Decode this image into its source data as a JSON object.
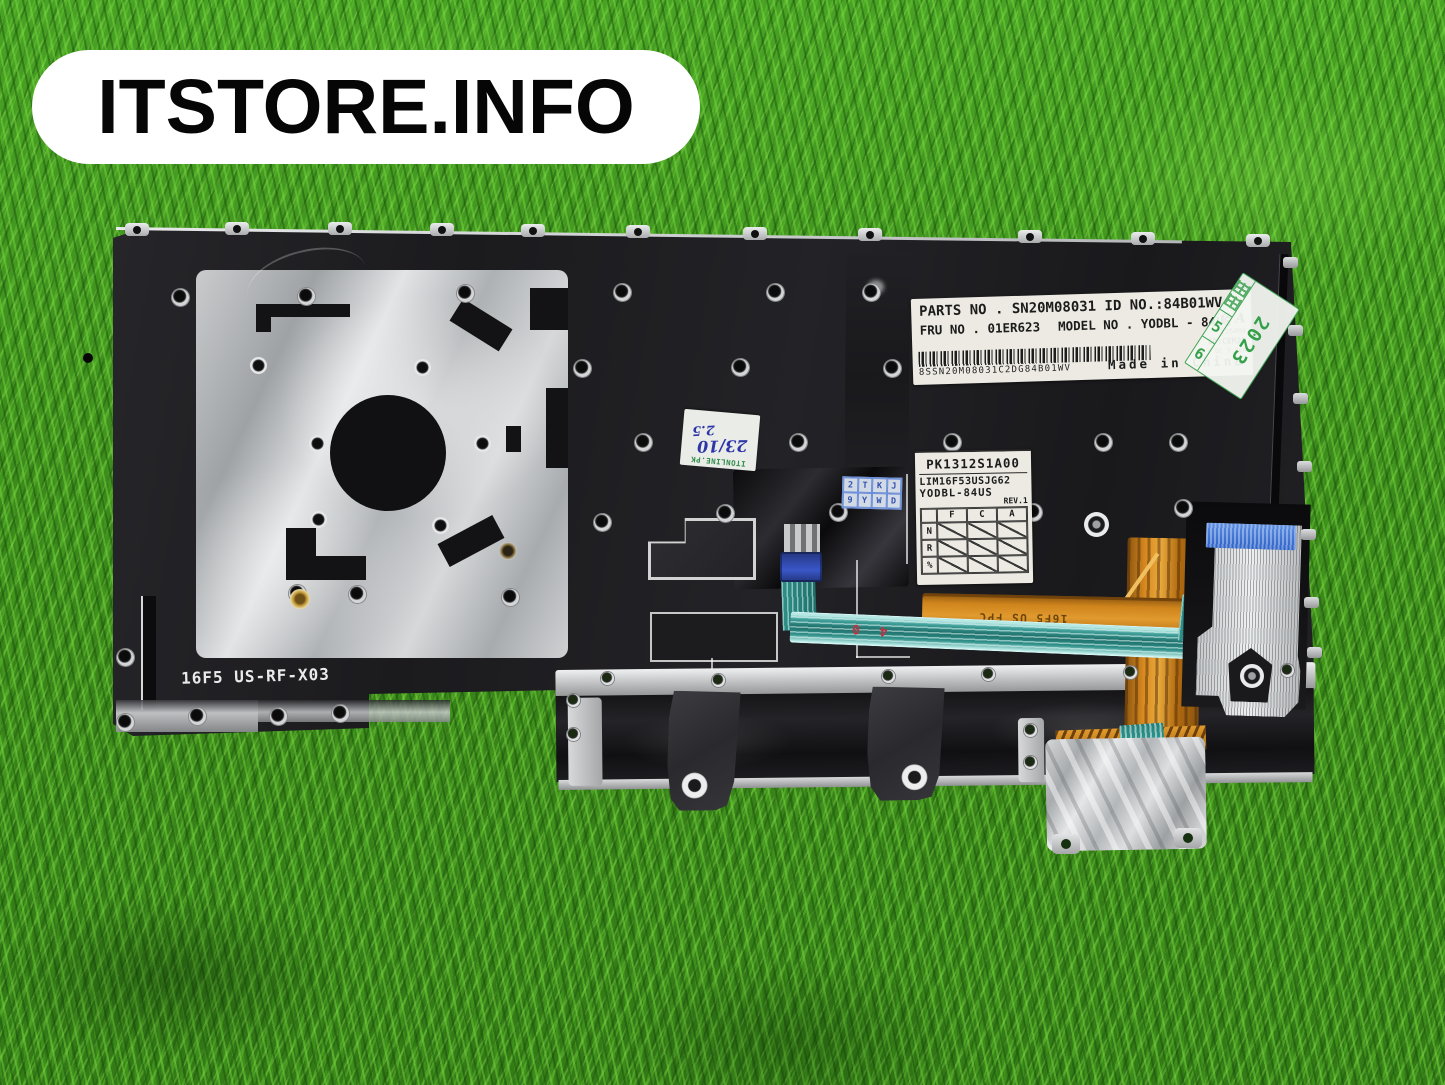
{
  "watermark": {
    "text": "ITSTORE.INFO"
  },
  "labels": {
    "main": {
      "line1": "PARTS NO . SN20M08031  ID NO.:84B01WV",
      "line2a": "FRU  NO . 01ER623",
      "line2b": "MODEL NO . YODBL - 84US",
      "cert_mark": "C A",
      "cert1": "E164M4",
      "cert2": "ID:CEM2M",
      "cert3": "4 V DC  7.0mA",
      "barcode_text": "8SSN20M08031C2DG84B01WV",
      "made_in": "Made in China"
    },
    "spec": {
      "part": "PK1312S1A00",
      "model_line1": "LIM16F53USJG62",
      "model_line2": "YODBL-84US",
      "rev": "REV.1",
      "columns": [
        "F",
        "C",
        "A"
      ],
      "rows": [
        "N",
        "R",
        "%"
      ]
    },
    "date_sticker": {
      "cjk": "绿标",
      "year": "2023",
      "cell_a": "5",
      "cell_b": "6"
    },
    "qc_sticker": {
      "row1": "2TKJ",
      "row2": "9YWD"
    },
    "note_sticker": {
      "brand": "ITONLINE.PK",
      "line1": "23/10",
      "line2": "2.5"
    },
    "prints": {
      "plate": "16F5 US-RF-X03",
      "fpc": "16F5 US FPC",
      "red_mark": "4 0"
    }
  },
  "colors": {
    "grass": "#3c8a1c",
    "plate_black": "#1c1c1f",
    "mylar_silver": "#c9cbcd",
    "label_white": "#edeae3",
    "fpc_orange": "#d98a1f",
    "flex_teal": "#2f8f8a",
    "stiffener_blue": "#2d62c8",
    "sticker_green": "#3fa353",
    "ink_blue": "#2d35a8"
  }
}
